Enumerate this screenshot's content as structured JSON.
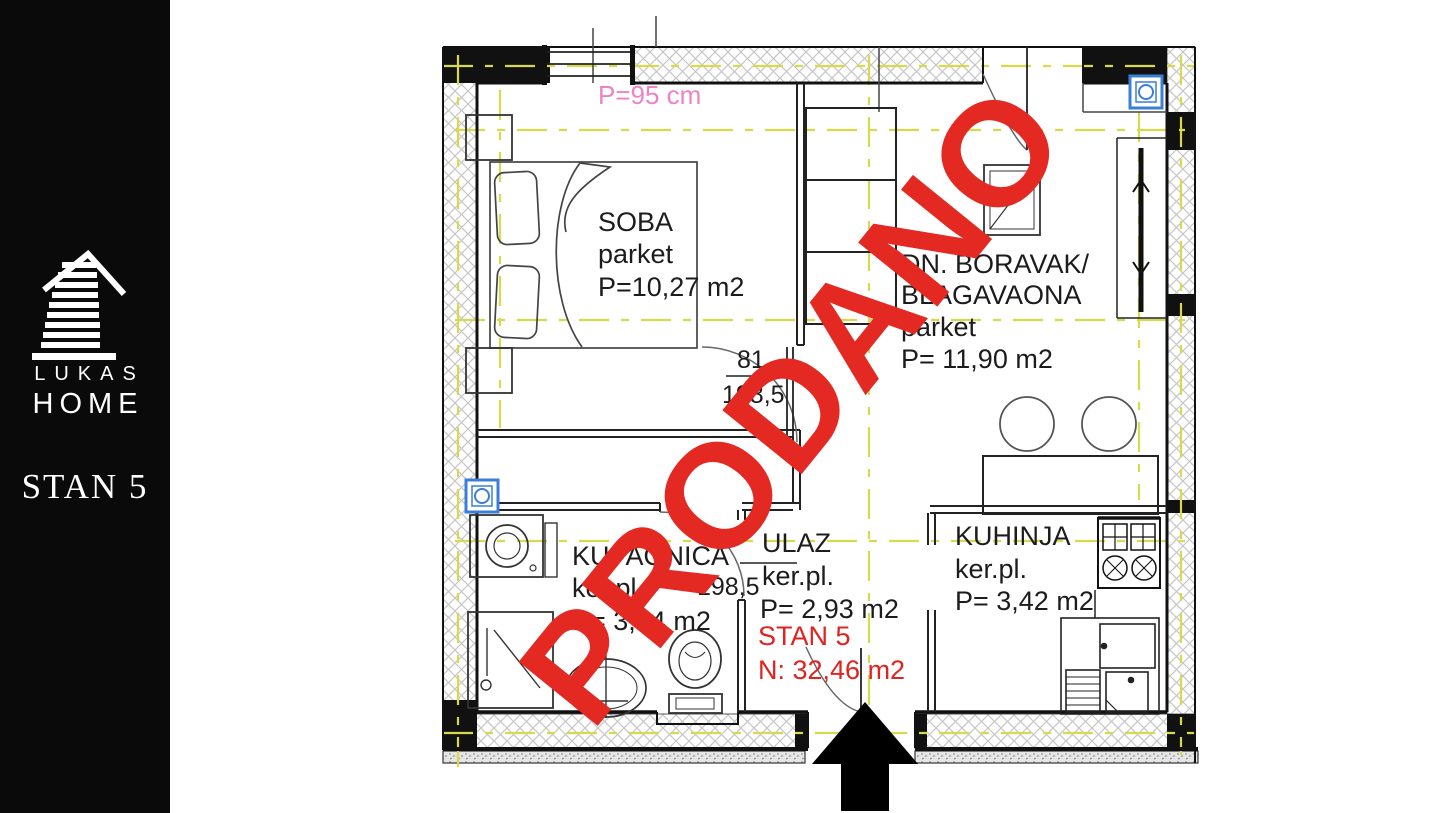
{
  "sidebar": {
    "brand_top": "LUKAS",
    "brand_bottom": "HOME",
    "unit_label": "STAN 5"
  },
  "watermark": {
    "text": "PRODANO"
  },
  "plan": {
    "window_label": "P=95 cm",
    "rooms": {
      "soba": {
        "name": "SOBA",
        "floor": "parket",
        "area": "P=10,27 m2"
      },
      "boravak": {
        "name_line1": "DN. BORAVAK/",
        "name_line2": "BLAGAVAONA",
        "floor": "parket",
        "area": "P= 11,90 m2"
      },
      "kupaonica": {
        "name": "KUPAONICA",
        "floor": "ker.pl.",
        "area": "P= 3,94 m2"
      },
      "ulaz": {
        "name": "ULAZ",
        "floor": "ker.pl.",
        "area": "P= 2,93 m2"
      },
      "kuhinja": {
        "name": "KUHINJA",
        "floor": "ker.pl.",
        "area": "P= 3,42 m2"
      }
    },
    "apartment": {
      "label": "STAN 5",
      "net_area": "N: 32,46 m2"
    },
    "dimensions": {
      "soba_door_width": "81",
      "soba_door_height": "198,5",
      "kupaonica_door_height": "198,5"
    },
    "colors": {
      "sold_red": "#e42822",
      "label_pink": "#ee82c8",
      "grid_yellow": "#d9d94e",
      "icon_blue": "#3b7fd4",
      "wall_black": "#111111"
    }
  }
}
